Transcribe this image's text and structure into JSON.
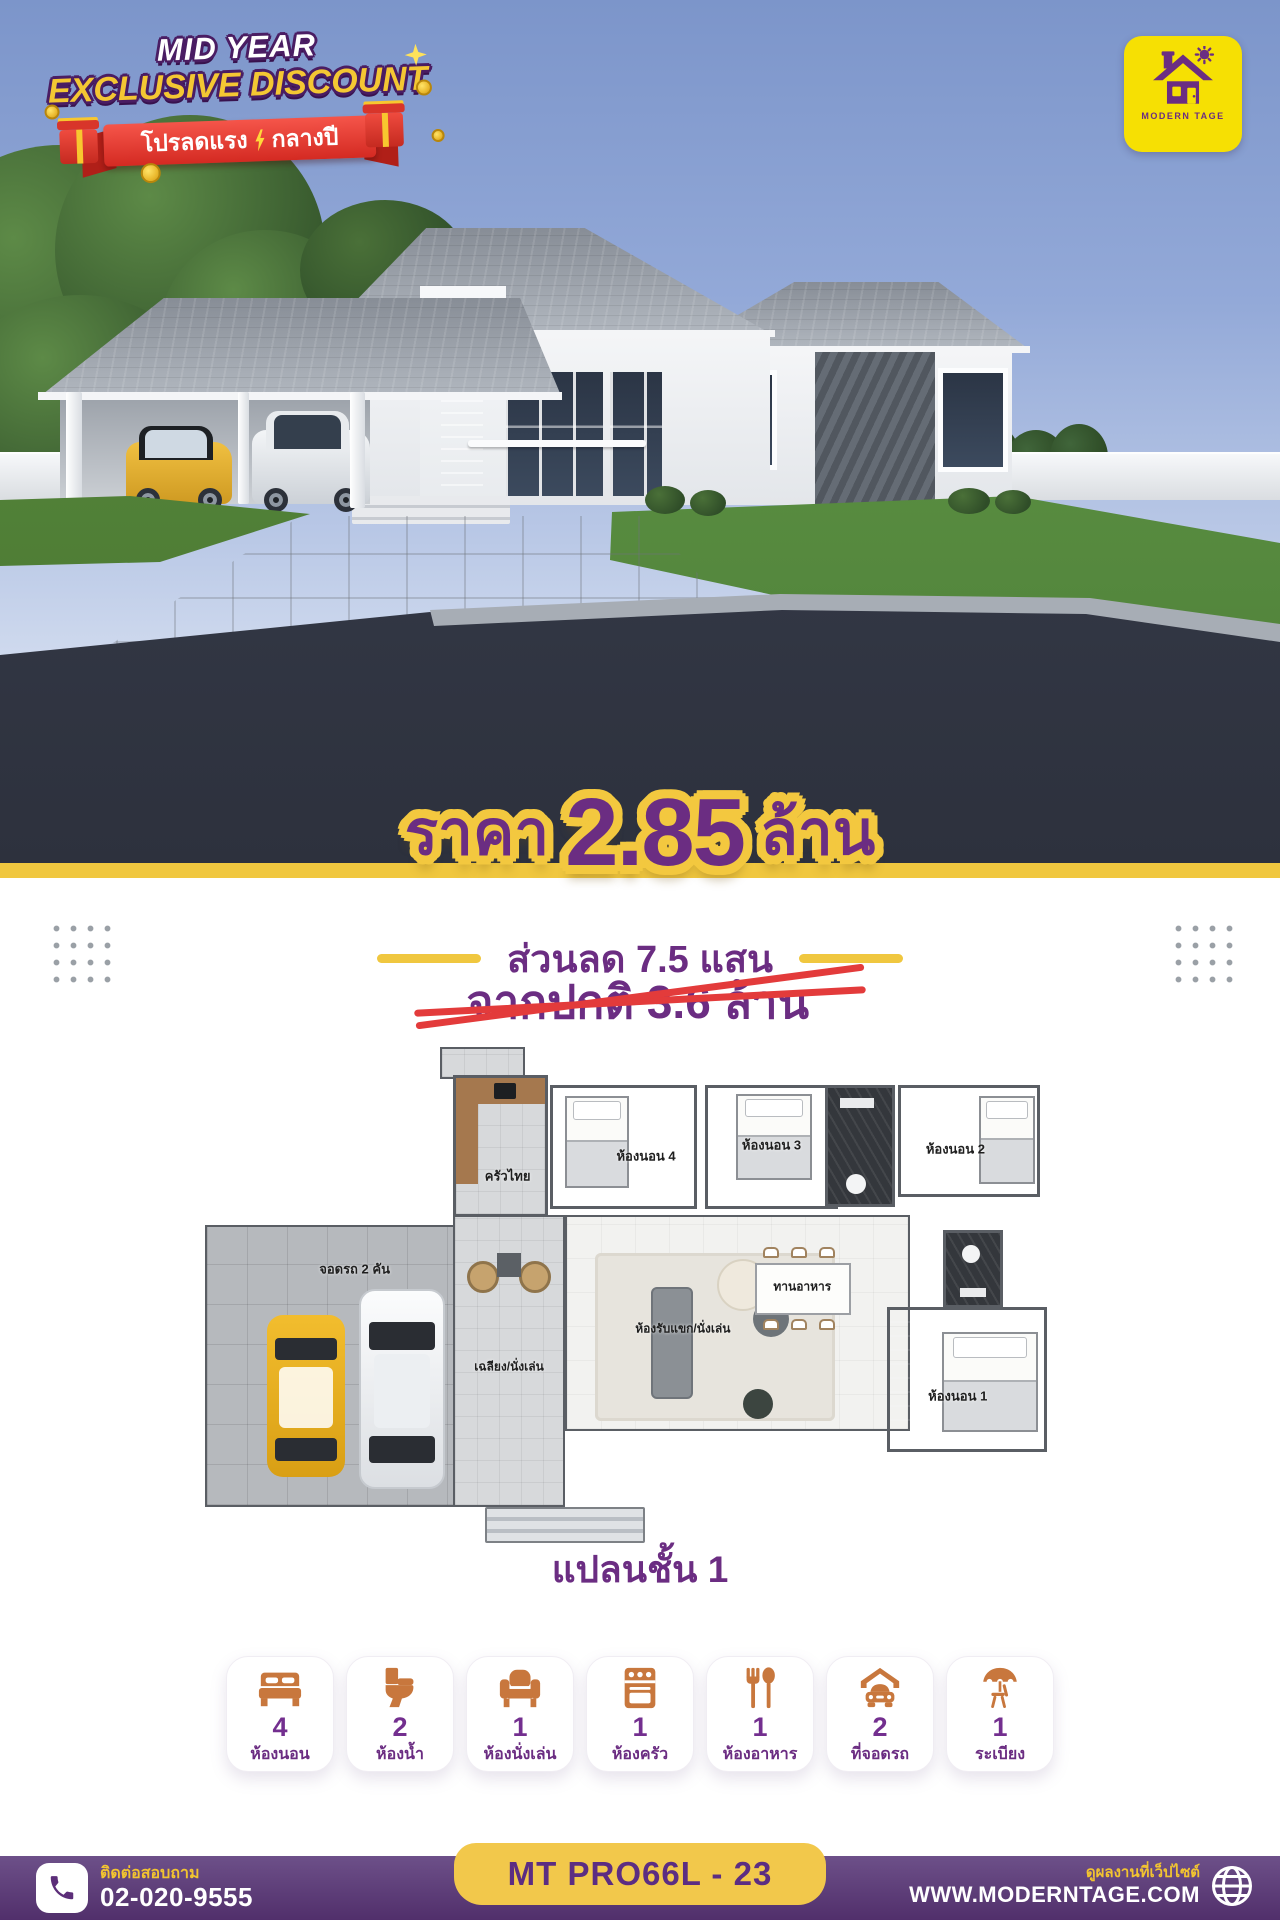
{
  "badge": {
    "line1": "MID YEAR",
    "line2": "EXCLUSIVE DISCOUNT",
    "ribbon_left": "โปรลดแรง",
    "ribbon_right": "กลางปี",
    "ribbon_color": "#d42a22",
    "line1_color": "#ffffff",
    "line2_color": "#f4c733",
    "outline_color": "#4a1d63"
  },
  "logo": {
    "name": "MODERN TAGE",
    "bg_color": "#f6e003",
    "fg_color": "#6b2d82"
  },
  "price": {
    "prefix": "ราคา",
    "amount": "2.85",
    "unit": "ล้าน",
    "text_color": "#6b2d82",
    "outline_color": "#f3c83f",
    "discount_line": "ส่วนลด 7.5 แสน",
    "original_line": "จากปกติ 3.6 ล้าน",
    "strike_color": "#e33b3b"
  },
  "floorplan": {
    "title": "แปลนชั้น 1",
    "rooms": {
      "kitchen": "ครัวไทย",
      "bedroom4": "ห้องนอน 4",
      "bedroom3": "ห้องนอน 3",
      "bedroom2": "ห้องนอน 2",
      "bedroom1": "ห้องนอน 1",
      "living": "ห้องรับแขก/นั่งเล่น",
      "dining": "ทานอาหาร",
      "porch": "เฉลียง/นั่งเล่น",
      "garage": "จอดรถ 2 คัน"
    }
  },
  "features": {
    "items": [
      {
        "icon": "bed-icon",
        "count": "4",
        "label": "ห้องนอน"
      },
      {
        "icon": "toilet-icon",
        "count": "2",
        "label": "ห้องน้ำ"
      },
      {
        "icon": "armchair-icon",
        "count": "1",
        "label": "ห้องนั่งเล่น"
      },
      {
        "icon": "stove-icon",
        "count": "1",
        "label": "ห้องครัว"
      },
      {
        "icon": "cutlery-icon",
        "count": "1",
        "label": "ห้องอาหาร"
      },
      {
        "icon": "carport-icon",
        "count": "2",
        "label": "ที่จอดรถ"
      },
      {
        "icon": "umbrella-chair-icon",
        "count": "1",
        "label": "ระเบียง"
      }
    ],
    "icon_color": "#c8773d",
    "count_color": "#732f8f"
  },
  "footer": {
    "contact_label": "ติดต่อสอบถาม",
    "phone": "02-020-9555",
    "model_code": "MT PRO66L - 23",
    "website_label": "ดูผลงานที่เว็ปไซต์",
    "website": "WWW.MODERNTAGE.COM",
    "bar_color": "#5e3c78",
    "pill_color": "#f2c84b"
  }
}
